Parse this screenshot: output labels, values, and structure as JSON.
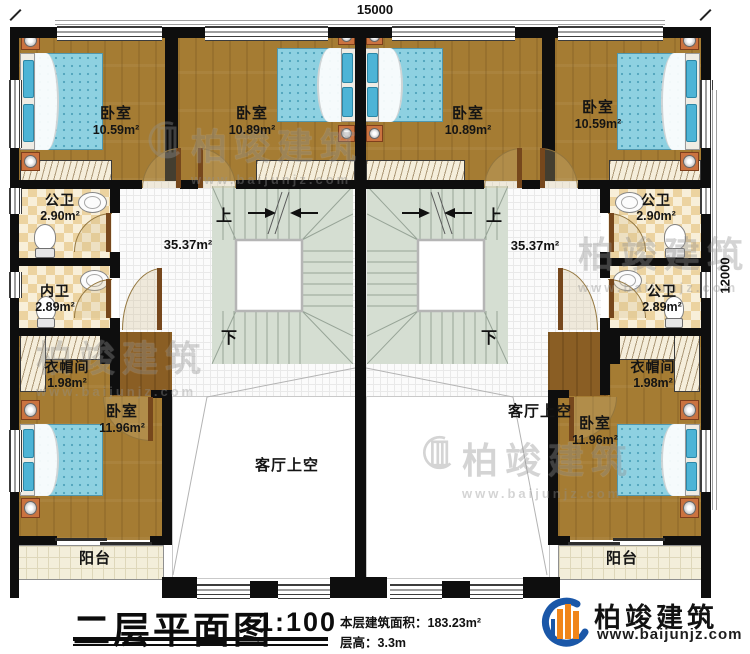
{
  "dimensions": {
    "width_label": "15000",
    "height_label": "12000"
  },
  "rooms": {
    "bedroom_1": {
      "name": "卧室",
      "area": "10.59m²"
    },
    "bedroom_2": {
      "name": "卧室",
      "area": "10.89m²"
    },
    "bedroom_3": {
      "name": "卧室",
      "area": "10.89m²"
    },
    "bedroom_4": {
      "name": "卧室",
      "area": "10.59m²"
    },
    "bath_left_top": {
      "name": "公卫",
      "area": "2.90m²"
    },
    "bath_left_bottom": {
      "name": "内卫",
      "area": "2.89m²"
    },
    "bath_right_top": {
      "name": "公卫",
      "area": "2.90m²"
    },
    "bath_right_bottom": {
      "name": "公卫",
      "area": "2.89m²"
    },
    "cloak_left": {
      "name": "衣帽间",
      "area": "1.98m²"
    },
    "cloak_right": {
      "name": "衣帽间",
      "area": "1.98m²"
    },
    "bedroom_5": {
      "name": "卧室",
      "area": "11.96m²"
    },
    "bedroom_6": {
      "name": "卧室",
      "area": "11.96m²"
    },
    "hall_left": {
      "area": "35.37m²"
    },
    "hall_right": {
      "area": "35.37m²"
    },
    "living_void_left": {
      "name": "客厅上空"
    },
    "living_void_right": {
      "name": "客厅上空"
    },
    "balcony_left": {
      "name": "阳台"
    },
    "balcony_right": {
      "name": "阳台"
    }
  },
  "stairs": {
    "up_label": "上",
    "down_label": "下"
  },
  "title_block": {
    "title": "二层平面图",
    "scale": "1:100",
    "area_label": "本层建筑面积：",
    "area_value": "183.23m²",
    "height_label": "层高：",
    "height_value": "3.3m"
  },
  "brand": {
    "name": "柏竣建筑",
    "url": "www.baijunjz.com"
  },
  "watermark": {
    "text": "柏竣建筑",
    "url": "www.baijunjz.com"
  }
}
